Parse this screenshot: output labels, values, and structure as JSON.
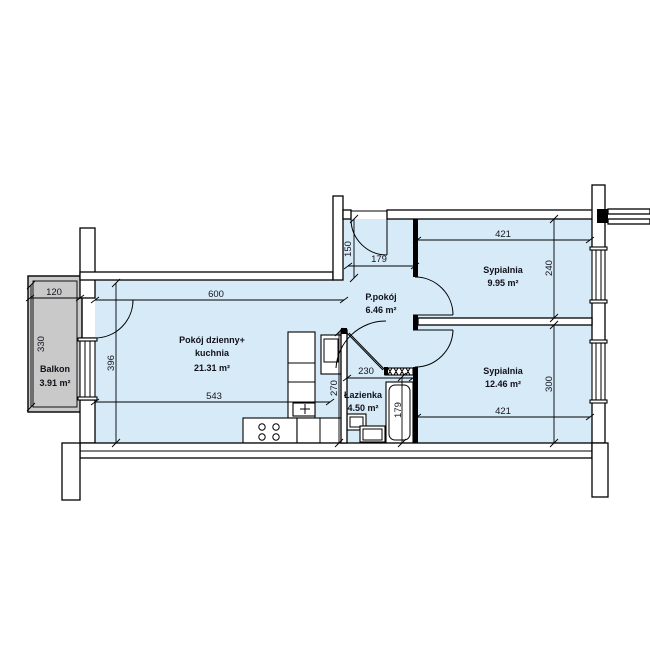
{
  "colors": {
    "floor": "#d7eaf7",
    "balcony": "#c9c9c9",
    "line": "#000000"
  },
  "rooms": {
    "living": {
      "name": "Pokój dzienny+",
      "name2": "kuchnia",
      "area": "21.31 m²"
    },
    "hall": {
      "name": "P.pokój",
      "area": "6.46 m²"
    },
    "bedroom1": {
      "name": "Sypialnia",
      "area": "9.95 m²"
    },
    "bedroom2": {
      "name": "Sypialnia",
      "area": "12.46 m²"
    },
    "bathroom": {
      "name": "Łazienka",
      "area": "4.50 m²"
    },
    "balcony": {
      "name": "Balkon",
      "area": "3.91 m²"
    }
  },
  "dims": {
    "balcony_width": "120",
    "balcony_depth": "330",
    "living_width_top": "600",
    "living_width_bottom": "543",
    "living_depth": "396",
    "hall_entry_depth": "150",
    "hall_width": "179",
    "bedroom1_width": "421",
    "bedroom1_depth": "240",
    "bedroom2_width": "421",
    "bedroom2_depth": "300",
    "bathroom_width": "230",
    "bathroom_depth": "270",
    "bathtub_length": "179"
  }
}
